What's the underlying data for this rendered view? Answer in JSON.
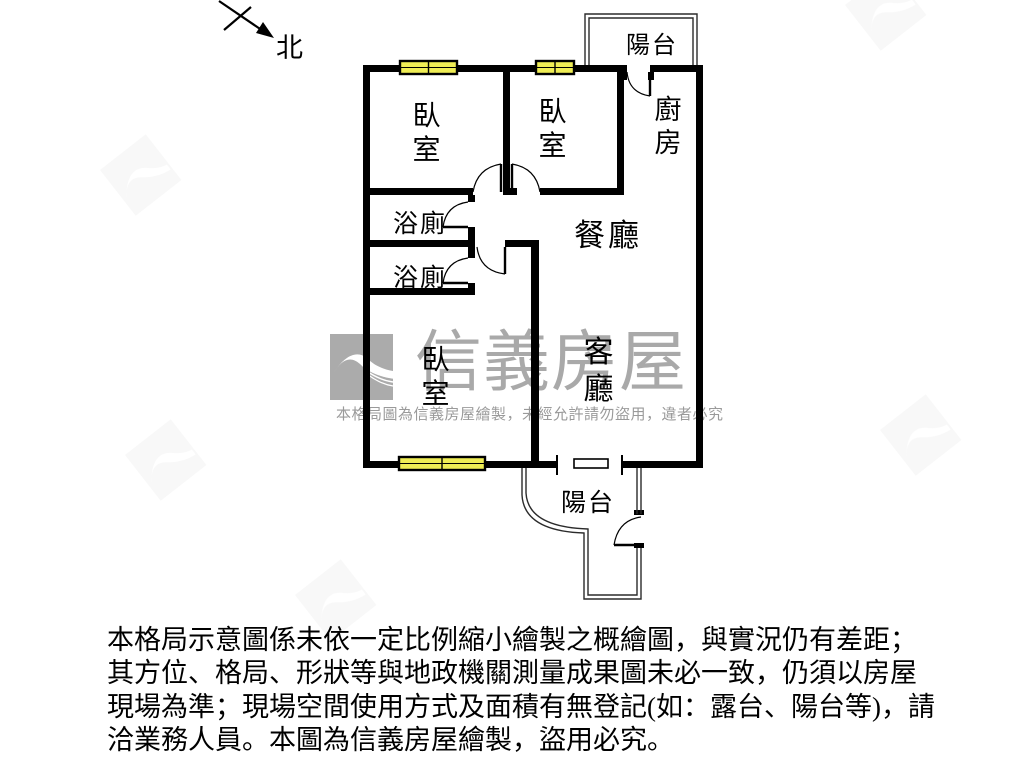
{
  "compass": {
    "north_label": "北"
  },
  "plan": {
    "rooms": {
      "balcony_top": {
        "label": "陽台"
      },
      "kitchen": {
        "label": "廚房"
      },
      "bedroom_top_left": {
        "label": "臥室"
      },
      "bedroom_top_mid": {
        "label": "臥室"
      },
      "bath_upper": {
        "label": "浴廁"
      },
      "bath_lower": {
        "label": "浴廁"
      },
      "dining": {
        "label": "餐廳"
      },
      "living": {
        "label": "客廳"
      },
      "bedroom_bottom": {
        "label": "臥室"
      },
      "balcony_bottom": {
        "label": "陽台"
      }
    },
    "colors": {
      "wall": "#000000",
      "window_fill": "#efed55",
      "window_border": "#000000",
      "thin_wall": "#2b2b2b",
      "watermark_gray": "#a9a9a9"
    }
  },
  "watermark": {
    "logo": "sinyi-bird-logo",
    "brand": "信義房屋",
    "notice": "本格局圖為信義房屋繪製，未經允許請勿盜用，違者必究"
  },
  "disclaimer": {
    "lines": [
      "本格局示意圖係未依一定比例縮小繪製之概繪圖，與實況仍有差距；",
      "其方位、格局、形狀等與地政機關測量成果圖未必一致，仍須以房屋",
      "現場為準；現場空間使用方式及面積有無登記(如：露台、陽台等)，請",
      "洽業務人員。本圖為信義房屋繪製，盜用必究。"
    ]
  }
}
